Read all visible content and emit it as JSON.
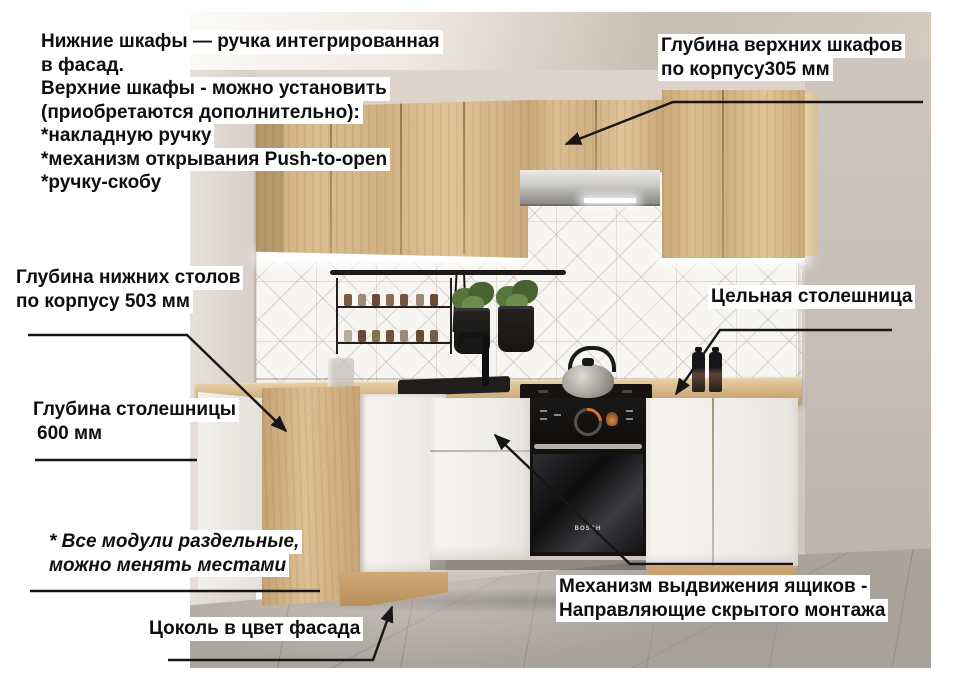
{
  "annotations": {
    "handles_note": {
      "lines": [
        "Нижние шкафы — ручка интегрированная",
        "в фасад.",
        "Верхние шкафы - можно установить",
        "(приобретаются дополнительно):",
        "*накладную ручку",
        "*механизм открывания Push-to-open",
        "*ручку-скобу"
      ]
    },
    "upper_depth": {
      "lines": [
        "Глубина верхних шкафов",
        "по корпусу305 мм"
      ]
    },
    "base_depth": {
      "lines": [
        "Глубина нижних столов",
        "по корпусу 503 мм"
      ]
    },
    "countertop_depth": {
      "lines": [
        "Глубина столешницы",
        "600 мм"
      ]
    },
    "modules_note": {
      "lines": [
        "* Все модули раздельные,",
        "можно менять местами"
      ]
    },
    "plinth_note": {
      "label": "Цоколь в цвет фасада"
    },
    "countertop_note": {
      "label": "Цельная столешница"
    },
    "drawers_note": {
      "lines": [
        "Механизм выдвижения ящиков -",
        "Направляющие скрытого монтажа"
      ]
    }
  },
  "scene": {
    "oven_brand": "BOSCH",
    "colors": {
      "wood_facade": "#d2b183",
      "wall": "#d5cdc4",
      "floor": "#a9a49c",
      "tile": "#f6f4f0",
      "annotation_text": "#111111",
      "label_background": "#ffffff",
      "led_light": "#ffffff",
      "oven_black": "#141210"
    }
  }
}
